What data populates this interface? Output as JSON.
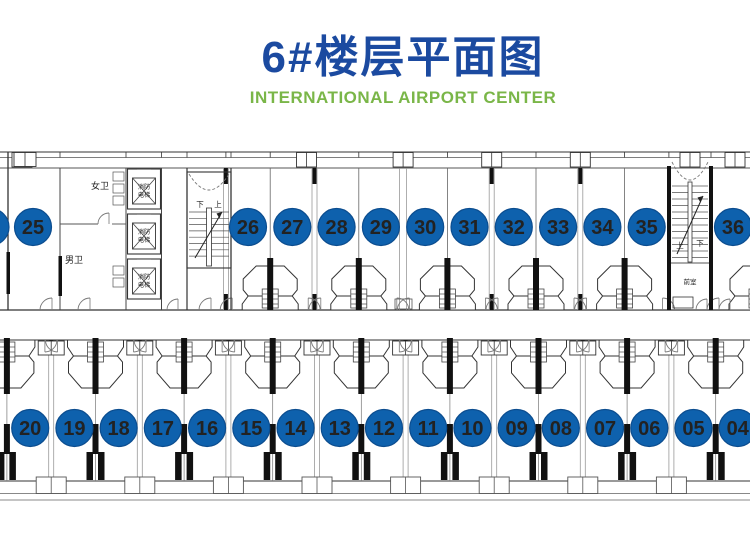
{
  "header": {
    "title": "6#楼层平面图",
    "subtitle": "INTERNATIONAL AIRPORT CENTER",
    "title_color": "#1b4aa0",
    "subtitle_color": "#7ab648"
  },
  "plan": {
    "unit_circle_color": "#0e61ad",
    "unit_circle_border_color": "#0c4d8f",
    "unit_number_color": "#ffffff",
    "line_color": "#333333",
    "top_row_units": [
      "25",
      "26",
      "27",
      "28",
      "29",
      "30",
      "31",
      "32",
      "33",
      "34",
      "35",
      "36"
    ],
    "bottom_row_units": [
      "20",
      "19",
      "18",
      "17",
      "16",
      "15",
      "14",
      "13",
      "12",
      "11",
      "10",
      "09",
      "08",
      "07",
      "06",
      "05",
      "04"
    ],
    "labels": {
      "womens_restroom": "女卫",
      "mens_restroom": "男卫",
      "fire_elevator_row1": "消防",
      "fire_elevator_row2": "电梯",
      "left_stair_down": "下",
      "left_stair_up": "上",
      "right_stair_up": "上",
      "right_stair_down": "下",
      "anteroom": "前室"
    }
  }
}
